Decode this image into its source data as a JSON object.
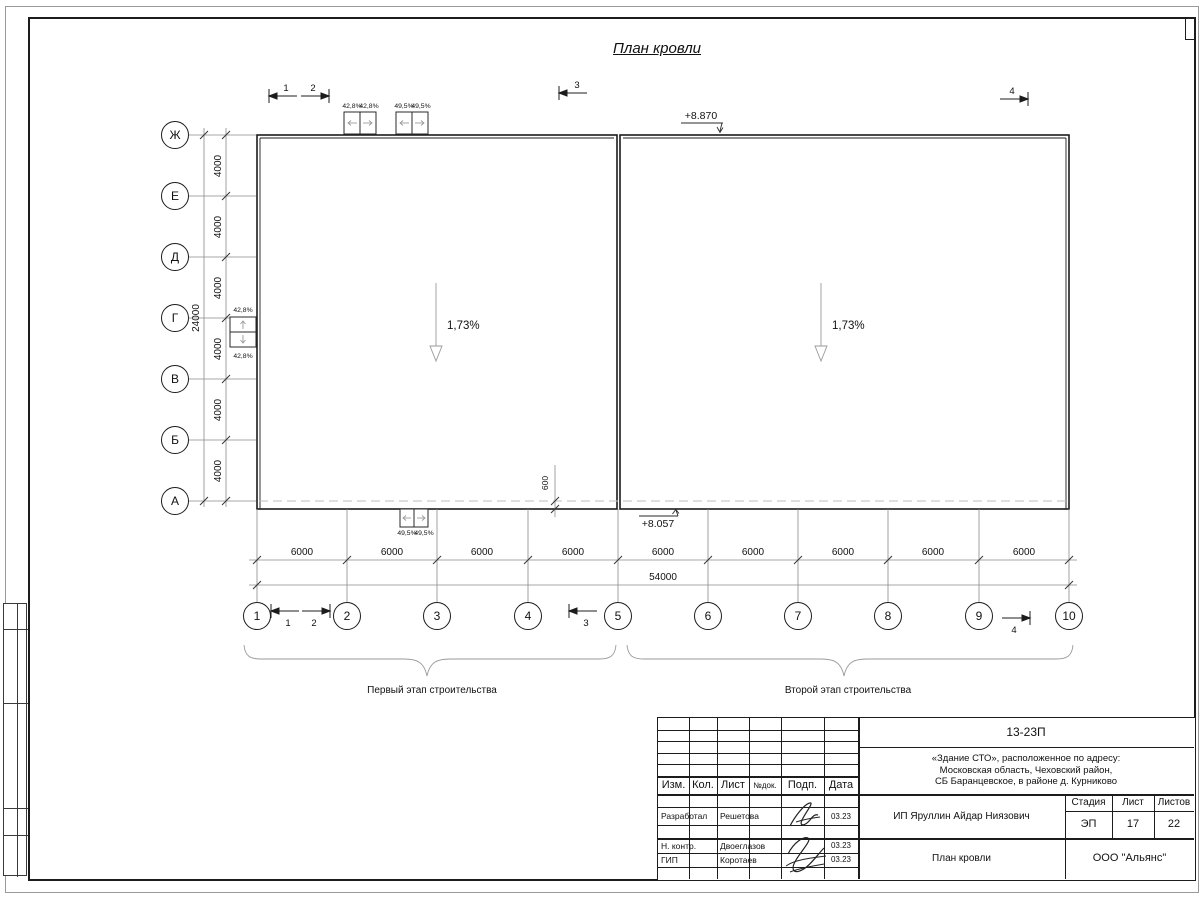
{
  "sheet": {
    "title": "План кровли"
  },
  "axes": {
    "rows": [
      "Ж",
      "Е",
      "Д",
      "Г",
      "В",
      "Б",
      "А"
    ],
    "cols": [
      "1",
      "2",
      "3",
      "4",
      "5",
      "6",
      "7",
      "8",
      "9",
      "10"
    ]
  },
  "dims": {
    "bay_v": "4000",
    "total_v": "24000",
    "bay_h": "6000",
    "total_h": "54000",
    "parapet": "600"
  },
  "marks": {
    "elev_top": "+8.870",
    "elev_bottom": "+8.057",
    "slope": "1,73%",
    "vent_a": "42,8%",
    "vent_b": "49,5%"
  },
  "sections": [
    "1",
    "2",
    "3",
    "4"
  ],
  "stages": {
    "first": "Первый этап строительства",
    "second": "Второй этап строительства"
  },
  "titleblock": {
    "doc_number": "13-23П",
    "project": [
      "«Здание СТО», расположенное по адресу:",
      "Московская область, Чеховский район,",
      "СБ Баранцевское, в районе д. Курниково"
    ],
    "cols": {
      "izm": "Изм.",
      "kol": "Кол.",
      "list": "Лист",
      "ndok": "№док.",
      "podp": "Подп.",
      "data": "Дата"
    },
    "rows": [
      {
        "role": "Разработал",
        "name": "Решетова",
        "date": "03.23"
      },
      {
        "role": "Н. контр.",
        "name": "Двоеглазов",
        "date": "03.23"
      },
      {
        "role": "ГИП",
        "name": "Коротаев",
        "date": "03.23"
      }
    ],
    "client": "ИП Яруллин Айдар Ниязович",
    "stage": {
      "label": "Стадия",
      "value": "ЭП"
    },
    "sheet": {
      "label": "Лист",
      "value": "17"
    },
    "sheets": {
      "label": "Листов",
      "value": "22"
    },
    "drawing_title": "План кровли",
    "company": "ООО \"Альянс\""
  }
}
